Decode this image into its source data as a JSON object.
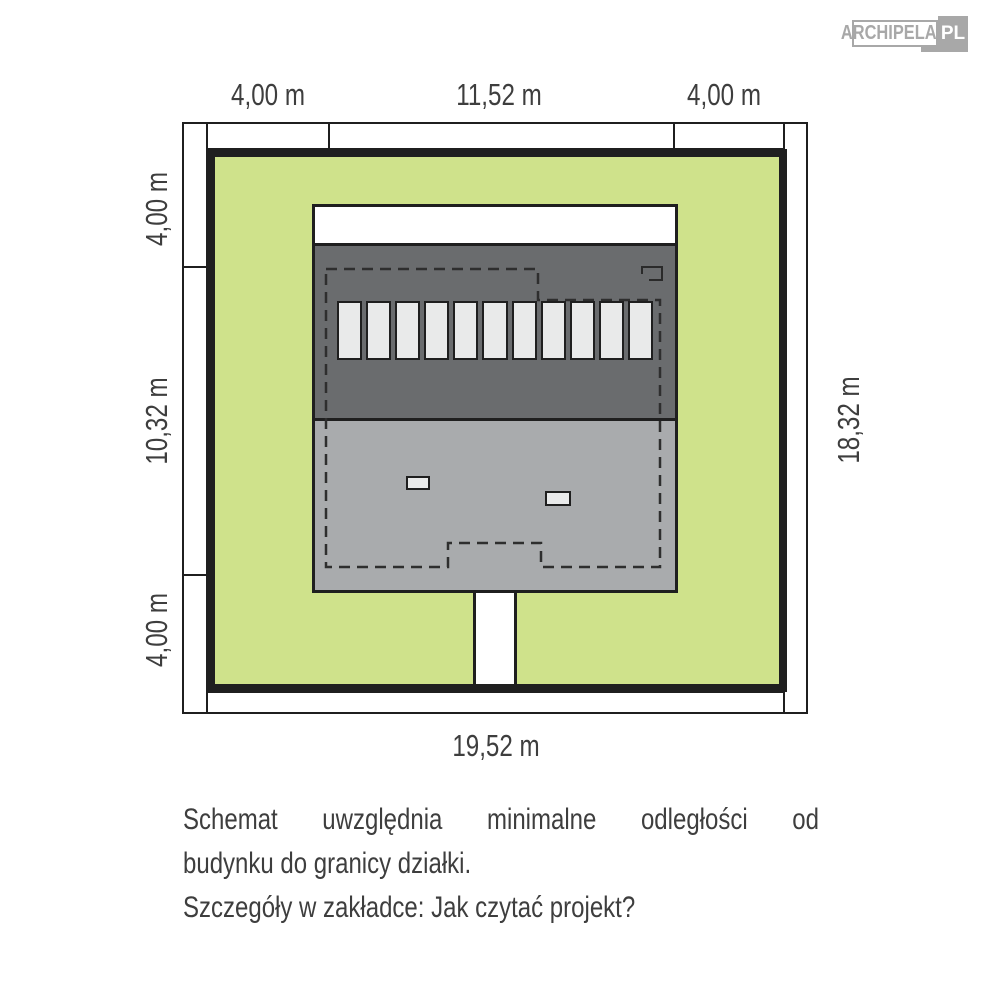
{
  "logo": {
    "brand": "ARCHIPELAG",
    "suffix": "PL"
  },
  "plan": {
    "dimensions": {
      "top_segments": [
        "4,00 m",
        "11,52 m",
        "4,00 m"
      ],
      "left_segments": [
        "4,00 m",
        "10,32 m",
        "4,00 m"
      ],
      "right_total": "18,32 m",
      "bottom_total": "19,52 m"
    },
    "house": {
      "roof_panels": {
        "count": 11
      }
    },
    "colors": {
      "plot_green": "#cfe28b",
      "roof_dark": "#6a6c6e",
      "roof_light": "#a9abad",
      "line": "#1f1f1f",
      "panel_fill": "#e9eaea",
      "logo_gray": "#a8a8a8",
      "text": "#3e3e3e"
    }
  },
  "caption": {
    "line1": "Schemat uwzględnia minimalne odległości od",
    "line2": "budynku do granicy działki.",
    "line3": "Szczegóły w zakładce: Jak czytać projekt?"
  }
}
